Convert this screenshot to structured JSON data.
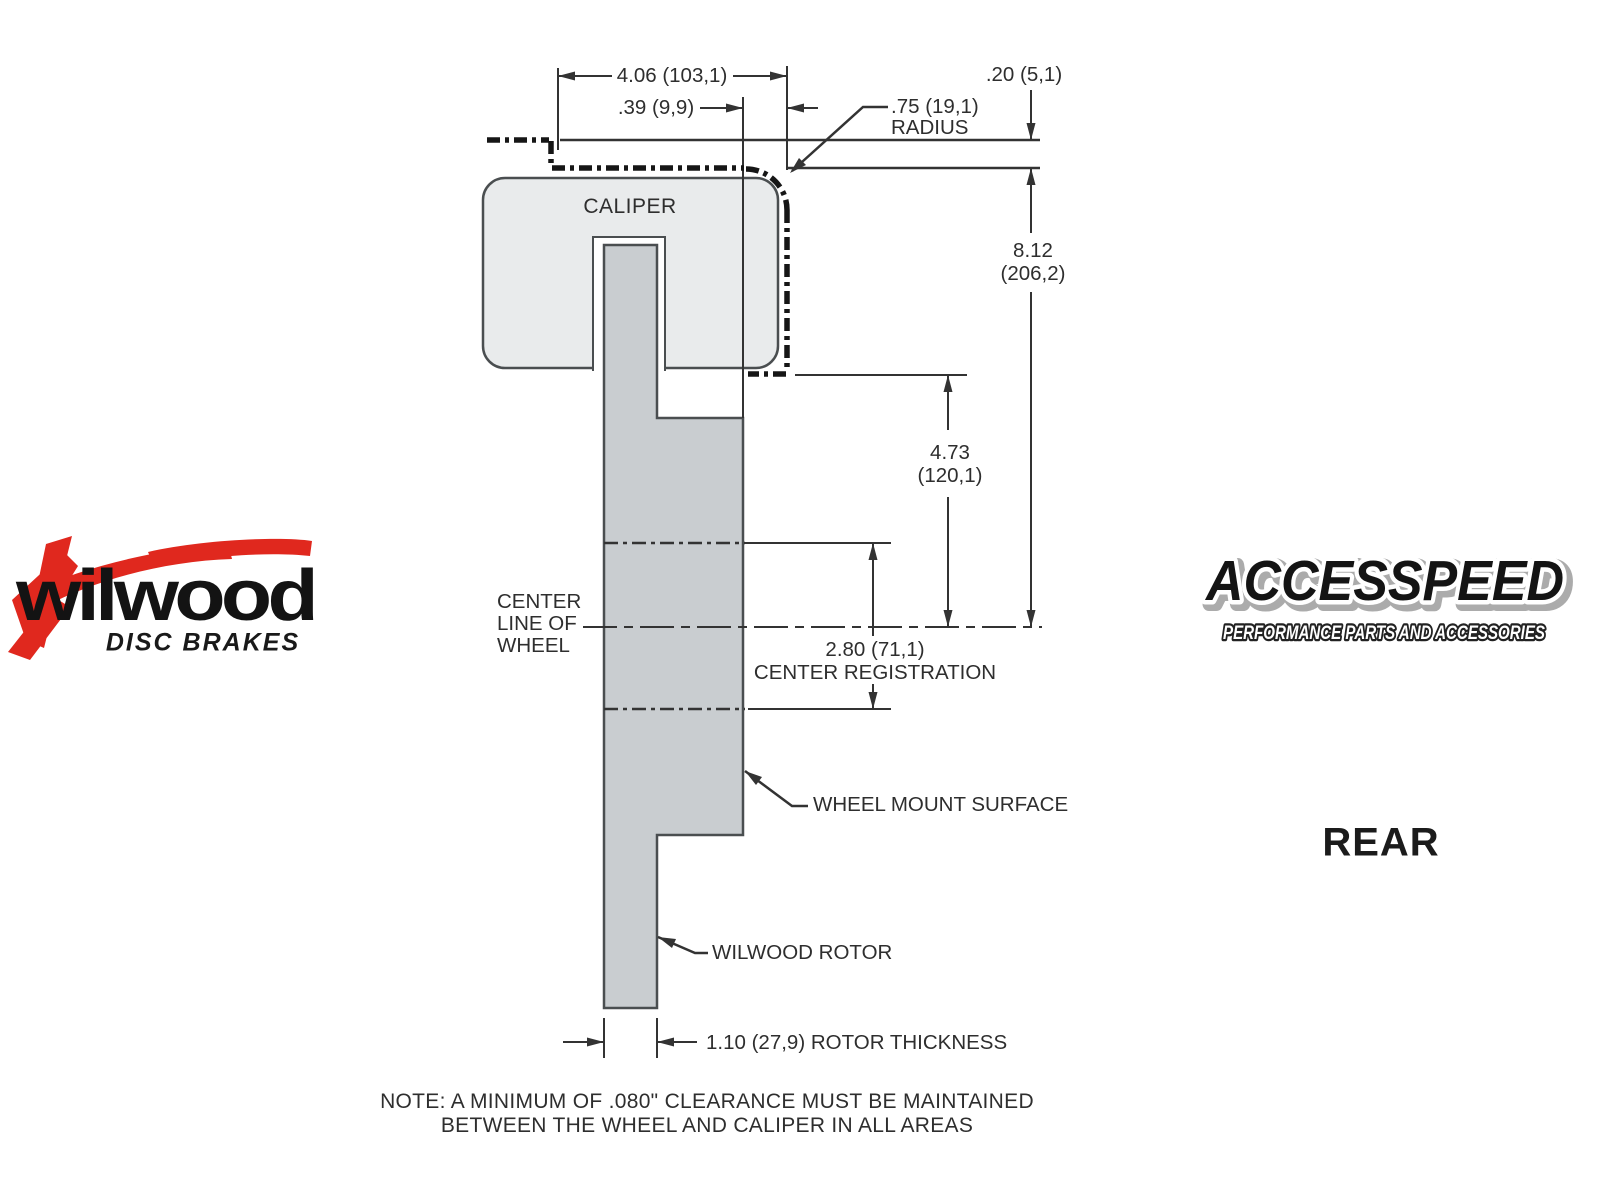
{
  "drawing": {
    "caliper_label": "CALIPER",
    "dim_width": "4.06 (103,1)",
    "dim_offset": ".39 (9,9)",
    "dim_clearance": ".20 (5,1)",
    "dim_radius_value": ".75 (19,1)",
    "dim_radius_word": "RADIUS",
    "dim_height_in": "8.12",
    "dim_height_mm": "(206,2)",
    "dim_mount_in": "4.73",
    "dim_mount_mm": "(120,1)",
    "dim_registration": "2.80 (71,1)",
    "dim_registration_label": "CENTER REGISTRATION",
    "dim_rotor_thickness": "1.10 (27,9) ROTOR THICKNESS",
    "label_center_line_1": "CENTER",
    "label_center_line_2": "LINE OF",
    "label_center_line_3": "WHEEL",
    "label_wheel_mount": "WHEEL MOUNT SURFACE",
    "label_rotor": "WILWOOD ROTOR",
    "note_line_1": "NOTE: A MINIMUM OF .080\" CLEARANCE MUST BE MAINTAINED",
    "note_line_2": "BETWEEN THE WHEEL AND CALIPER IN ALL AREAS",
    "view_label": "REAR"
  },
  "logos": {
    "wilwood_name": "wilwood",
    "wilwood_tagline": "DISC BRAKES",
    "accesspeed_name": "ACCESSPEED",
    "accesspeed_tagline": "PERFORMANCE PARTS AND ACCESSORIES"
  },
  "colors": {
    "caliper_fill": "#e9ebec",
    "rotor_fill": "#c9cdd0",
    "outline": "#4a4e50",
    "dim_line": "#333333",
    "wheel_profile": "#161616",
    "wilwood_red": "#e0281e"
  }
}
